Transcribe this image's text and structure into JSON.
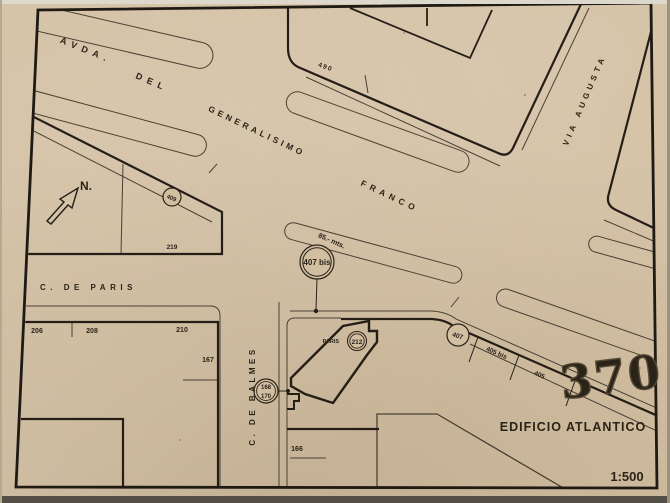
{
  "colors": {
    "paper": "#d3c0a3",
    "ink_dark": "#241e16",
    "ink_light": "#4a4034",
    "stamp_ink": "#564a36"
  },
  "streets": {
    "avenue_word1": "AVDA.",
    "avenue_word2": "DEL",
    "avenue_word3": "GENERALISIMO",
    "avenue_word4": "FRANCO",
    "via_augusta": "VIA AUGUSTA",
    "calle_paris": "C. DE PARIS",
    "calle_balmes": "C. DE BALMES"
  },
  "labels": {
    "north": "N.",
    "dimension_85": "85.- mts.",
    "building_name": "EDIFICIO ATLANTICO",
    "scale": "1:500",
    "stamp_number": "370",
    "paris_tag": "PARIS"
  },
  "refs": {
    "r409": "409",
    "r407bis": "407 bis",
    "r407": "407",
    "r212": "212",
    "r168": "168",
    "r170": "170"
  },
  "parcels": {
    "p490": "490",
    "p219": "219",
    "p206": "206",
    "p208": "208",
    "p210": "210",
    "p167": "167",
    "p166": "166",
    "p405bis": "405 bis",
    "p405": "405"
  }
}
